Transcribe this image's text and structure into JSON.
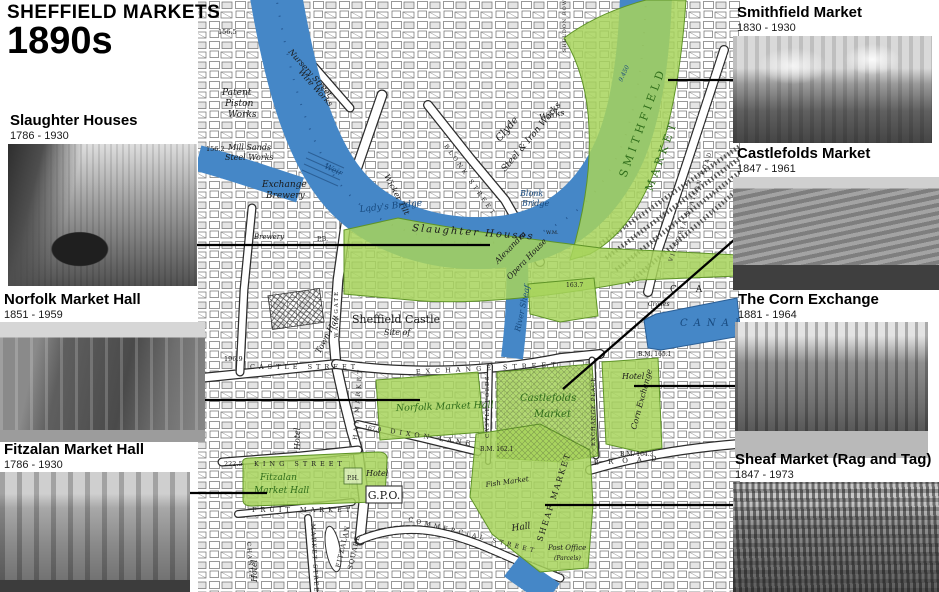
{
  "header": {
    "title": "SHEFFIELD MARKETS",
    "subtitle": "1890s"
  },
  "cards": {
    "slaughter": {
      "title": "Slaughter Houses",
      "dates": "1786 - 1930"
    },
    "norfolk": {
      "title": "Norfolk Market Hall",
      "dates": "1851 - 1959"
    },
    "fitzalan": {
      "title": "Fitzalan Market Hall",
      "dates": "1786 - 1930"
    },
    "smithfield": {
      "title": "Smithfield Market",
      "dates": "1830 - 1930"
    },
    "castlefolds": {
      "title": "Castlefolds Market",
      "dates": "1847 - 1961"
    },
    "corn": {
      "title": "The Corn Exchange",
      "dates": "1881 - 1964"
    },
    "sheaf": {
      "title": "Sheaf Market (Rag and Tag)",
      "dates": "1847 - 1973"
    }
  },
  "colors": {
    "water": "#4587c7",
    "market_green": "#a7d45c",
    "leader": "#000000"
  },
  "map": {
    "patent": [
      "Patent",
      "Piston",
      "Works"
    ],
    "mill": [
      "Mill Sands",
      "Steel Works"
    ],
    "h156_2": "156.2",
    "h156_5": "156.5",
    "nursery": "Nursery Street",
    "wire": "Wire Works",
    "weir": "Weir",
    "wicker_tilt": "Wicker Tilt",
    "exchange_brewery": [
      "Exchange",
      "Brewery"
    ],
    "brewery_sm": "Brewery",
    "pb": "P.B.",
    "ladys_bridge": "Lady's Bridge",
    "slaughter": "Slaughter Houses",
    "clyde": [
      "Clyde",
      "Steel & Iron Works"
    ],
    "blonk_street": "BLONK STREET",
    "blonk_bridge": [
      "Blonk",
      "Bridge"
    ],
    "sheldon_row": "SHELDON ROW",
    "works": "Works",
    "river_num": "9.450",
    "smithfield": [
      "SMITHFIELD",
      "MARKET"
    ],
    "victoria": "VICTORIA STATION ROAD",
    "castle": [
      "Sheffield Castle",
      "Site of"
    ],
    "river_sheaf": "River Sheaf",
    "waingate": "WAINGATE",
    "town_hall": "Town Hall",
    "castle_street": "CASTLE STREET",
    "h196": "196.9",
    "exchange_street": "EXCHANGE STREET",
    "haymarket": "HAY MARKET",
    "king_num": "222.5",
    "king": "KING STREET",
    "dixon_num": "167.0",
    "dixon": "DIXON LANE",
    "norfolk": "Norfolk Market Hall",
    "castle_folds": "CASTLE FOLDS",
    "castlefolds": [
      "Castlefolds",
      "Market"
    ],
    "exchange_place": "EXCHANGE PLACE",
    "hotel": "Hotel",
    "corn_exchange": "Corn Exchange",
    "canal": "CANAL",
    "ca": "C A",
    "cranes": "Cranes",
    "bm165": "B.M. 165.1",
    "bm162": "B.M. 162.1",
    "bm164": "B.M. 164.3",
    "h163": "163.7",
    "wm": "W.M.",
    "alexandra": [
      "Alexandra",
      "Opera House"
    ],
    "broad": "BROAD",
    "fitzalan": [
      "Fitzalan",
      "Market Hall"
    ],
    "ph": "P.H.",
    "fruit": "FRUIT MARKET",
    "gpo": "G.P.O.",
    "change": "CHANGE",
    "market_street": "MARKET STREET",
    "fitzalan_sq": [
      "FITZALAN",
      "SQUARE"
    ],
    "commercial": "COMMERCIAL STREET",
    "fish": "Fish Market",
    "sheaf": "SHEAF MARKET",
    "hall": "Hall",
    "post_office": [
      "Post Office",
      "(Parcels)"
    ]
  }
}
